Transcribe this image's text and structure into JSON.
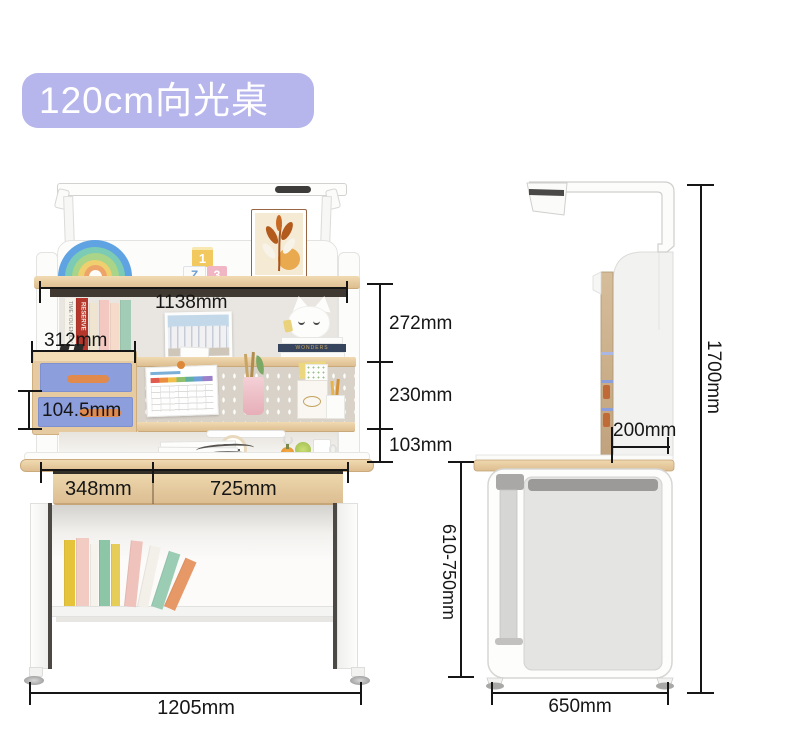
{
  "title": "120cm向光桌Max",
  "badge": {
    "bg_color": "#b6b5ec",
    "text_color": "#ffffff"
  },
  "accent_colors": {
    "wood": "#e7cda6",
    "drawer_fabric_blue": "#8d9edd",
    "handle_orange": "#e08a4e",
    "dimension_line": "#161616"
  },
  "front_view": {
    "label": "front view",
    "dimensions": {
      "shelf_inner_width": "1138mm",
      "upper_compartment_height": "272mm",
      "middle_compartment_height": "230mm",
      "desktop_clearance_height": "103mm",
      "side_drawer_unit_width": "312mm",
      "side_drawer_height": "104.5mm",
      "left_drawer_width": "348mm",
      "right_drawer_width": "725mm",
      "overall_width": "1205mm"
    },
    "decor": {
      "toy_blocks": [
        "1",
        "Z",
        "3"
      ],
      "book_spines": [
        "TIME YOU ENJOY",
        "RESERVE"
      ],
      "stack_book_title": "WONDERS",
      "magazine_title": "FURNITURE"
    }
  },
  "side_view": {
    "label": "side view",
    "dimensions": {
      "upper_shelf_depth": "200mm",
      "overall_height": "1700mm",
      "desktop_height_range": "610-750mm",
      "desk_depth": "650mm"
    }
  }
}
